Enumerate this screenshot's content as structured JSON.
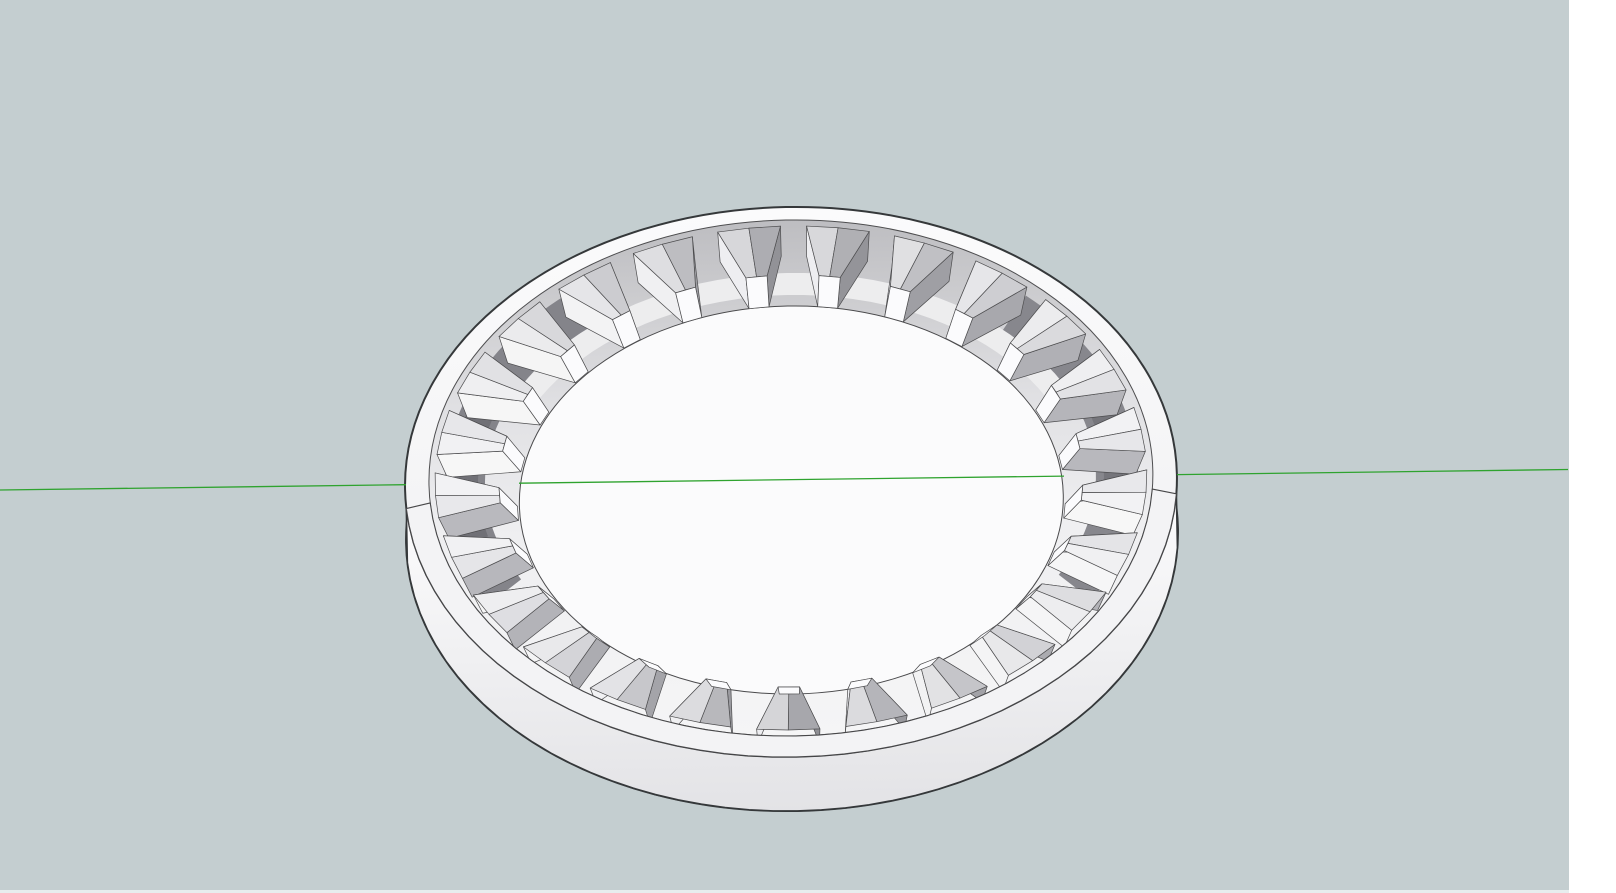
{
  "window": {
    "width": 1616,
    "height": 893,
    "right_margin": {
      "x": 1569,
      "color": "#ffffff"
    },
    "bottom_strip": {
      "height": 3,
      "color": "#e7edee"
    }
  },
  "viewport": {
    "label": "3d-viewport",
    "width": 1569,
    "height": 893,
    "background": "#c4ced0",
    "axis": {
      "name": "green-axis",
      "color": "#2fa32f",
      "width": 1.3,
      "y_at_left": 490,
      "y_at_right": 469.5,
      "visible_segments": [
        [
          0,
          406
        ],
        [
          519,
          1064
        ],
        [
          1177,
          1568
        ]
      ]
    },
    "model": {
      "type": "internal ring gear",
      "center": [
        791,
        483
      ],
      "tilt_deg": -1.1,
      "tooth_count": 25,
      "tooth_start_deg": 96,
      "tooth_base_half_deg": 5.1,
      "tooth_tip_half_deg": 2.1,
      "ellipses": {
        "outer_top": [
          791,
          482,
          386,
          275
        ],
        "band_inner": [
          791,
          478,
          362,
          258
        ],
        "wall_bottom": [
          791,
          536,
          386,
          275
        ],
        "tooth_top_outer": [
          791,
          478,
          356,
          252
        ],
        "tooth_top_tip": [
          791,
          481,
          292,
          206
        ],
        "tooth_floor_tip": [
          791,
          500,
          274,
          194
        ],
        "tooth_floor_outer": [
          791,
          500,
          346,
          244
        ],
        "disk": [
          791,
          500,
          272,
          194
        ],
        "floor_arc": [
          791,
          497,
          302,
          213
        ],
        "shade_arc": [
          791,
          480,
          326,
          226
        ]
      },
      "colors": {
        "edge": "#4d4d4f",
        "silhouette": "#35383a",
        "face_white": "#fbfbfc",
        "rim_gradient": [
          "#fbfbfc",
          "#eeeef0"
        ],
        "outer_wall_gradient": [
          "#fcfcfd",
          "#e3e3e6"
        ],
        "inner_wall_stops": [
          [
            0,
            "#bdbdc1"
          ],
          [
            0.12,
            "#c9c9cc"
          ],
          [
            0.35,
            "#e0e0e3"
          ],
          [
            0.6,
            "#efeff1"
          ],
          [
            1,
            "#f5f5f6"
          ]
        ],
        "near_band_fill": "#f3f3f5",
        "near_band_edge": "#474749",
        "floor_light": "#ededee",
        "disk_edge": "#4a4a4c",
        "shade_arcs": [
          {
            "a0": 130,
            "a1": 208,
            "color": "#84848a",
            "width": 40
          },
          {
            "a0": 152,
            "a1": 194,
            "color": "#707076",
            "width": 26
          },
          {
            "a0": -30,
            "a1": 46,
            "color": "#87878d",
            "width": 42
          },
          {
            "a0": -8,
            "a1": 24,
            "color": "#75757b",
            "width": 26
          }
        ],
        "tooth": {
          "light_half": [
            "#d4d4d7",
            "#f2f2f4"
          ],
          "dark_half": [
            "#a6a6ab",
            "#e8e8eb"
          ],
          "light_flank": [
            "#ededf0",
            "#f7f7f7"
          ],
          "dark_flank": [
            "#8e8e93",
            "#b9b9be"
          ],
          "tip": "#fbfbfd",
          "backface_blue": "#8c91a6",
          "backface_tooth_index": 3
        }
      }
    }
  }
}
